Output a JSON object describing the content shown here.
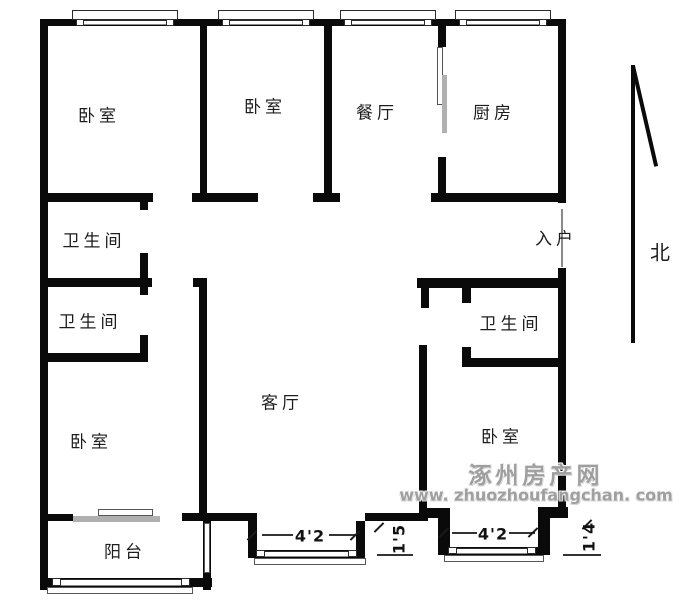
{
  "plan": {
    "rooms": [
      {
        "id": "bedroom-top-left",
        "label": "卧室"
      },
      {
        "id": "bedroom-top-middle",
        "label": "卧室"
      },
      {
        "id": "dining-room",
        "label": "餐厅"
      },
      {
        "id": "kitchen",
        "label": "厨房"
      },
      {
        "id": "bathroom-upper-left",
        "label": "卫生间"
      },
      {
        "id": "bathroom-middle-left",
        "label": "卫生间"
      },
      {
        "id": "bathroom-right",
        "label": "卫生间"
      },
      {
        "id": "entry",
        "label": "入户"
      },
      {
        "id": "living-room",
        "label": "客厅"
      },
      {
        "id": "bedroom-bottom-left",
        "label": "卧室"
      },
      {
        "id": "bedroom-bottom-right",
        "label": "卧室"
      },
      {
        "id": "balcony",
        "label": "阳台"
      }
    ],
    "compass": {
      "label": "北"
    },
    "dimensions": {
      "bay_left": "4'2",
      "gap_middle": "1'5",
      "bay_right": "4'2",
      "gap_right": "1'4"
    },
    "watermark": {
      "site_name": "涿州房产网",
      "site_url": "www. zhuozhoufangchan. com"
    }
  },
  "colors": {
    "wall": "#0a0a0a",
    "thin_line": "#555555",
    "sliding_door": "#b0b0b0",
    "watermark": "#9f9f9f",
    "label": "#1d1d1d"
  }
}
